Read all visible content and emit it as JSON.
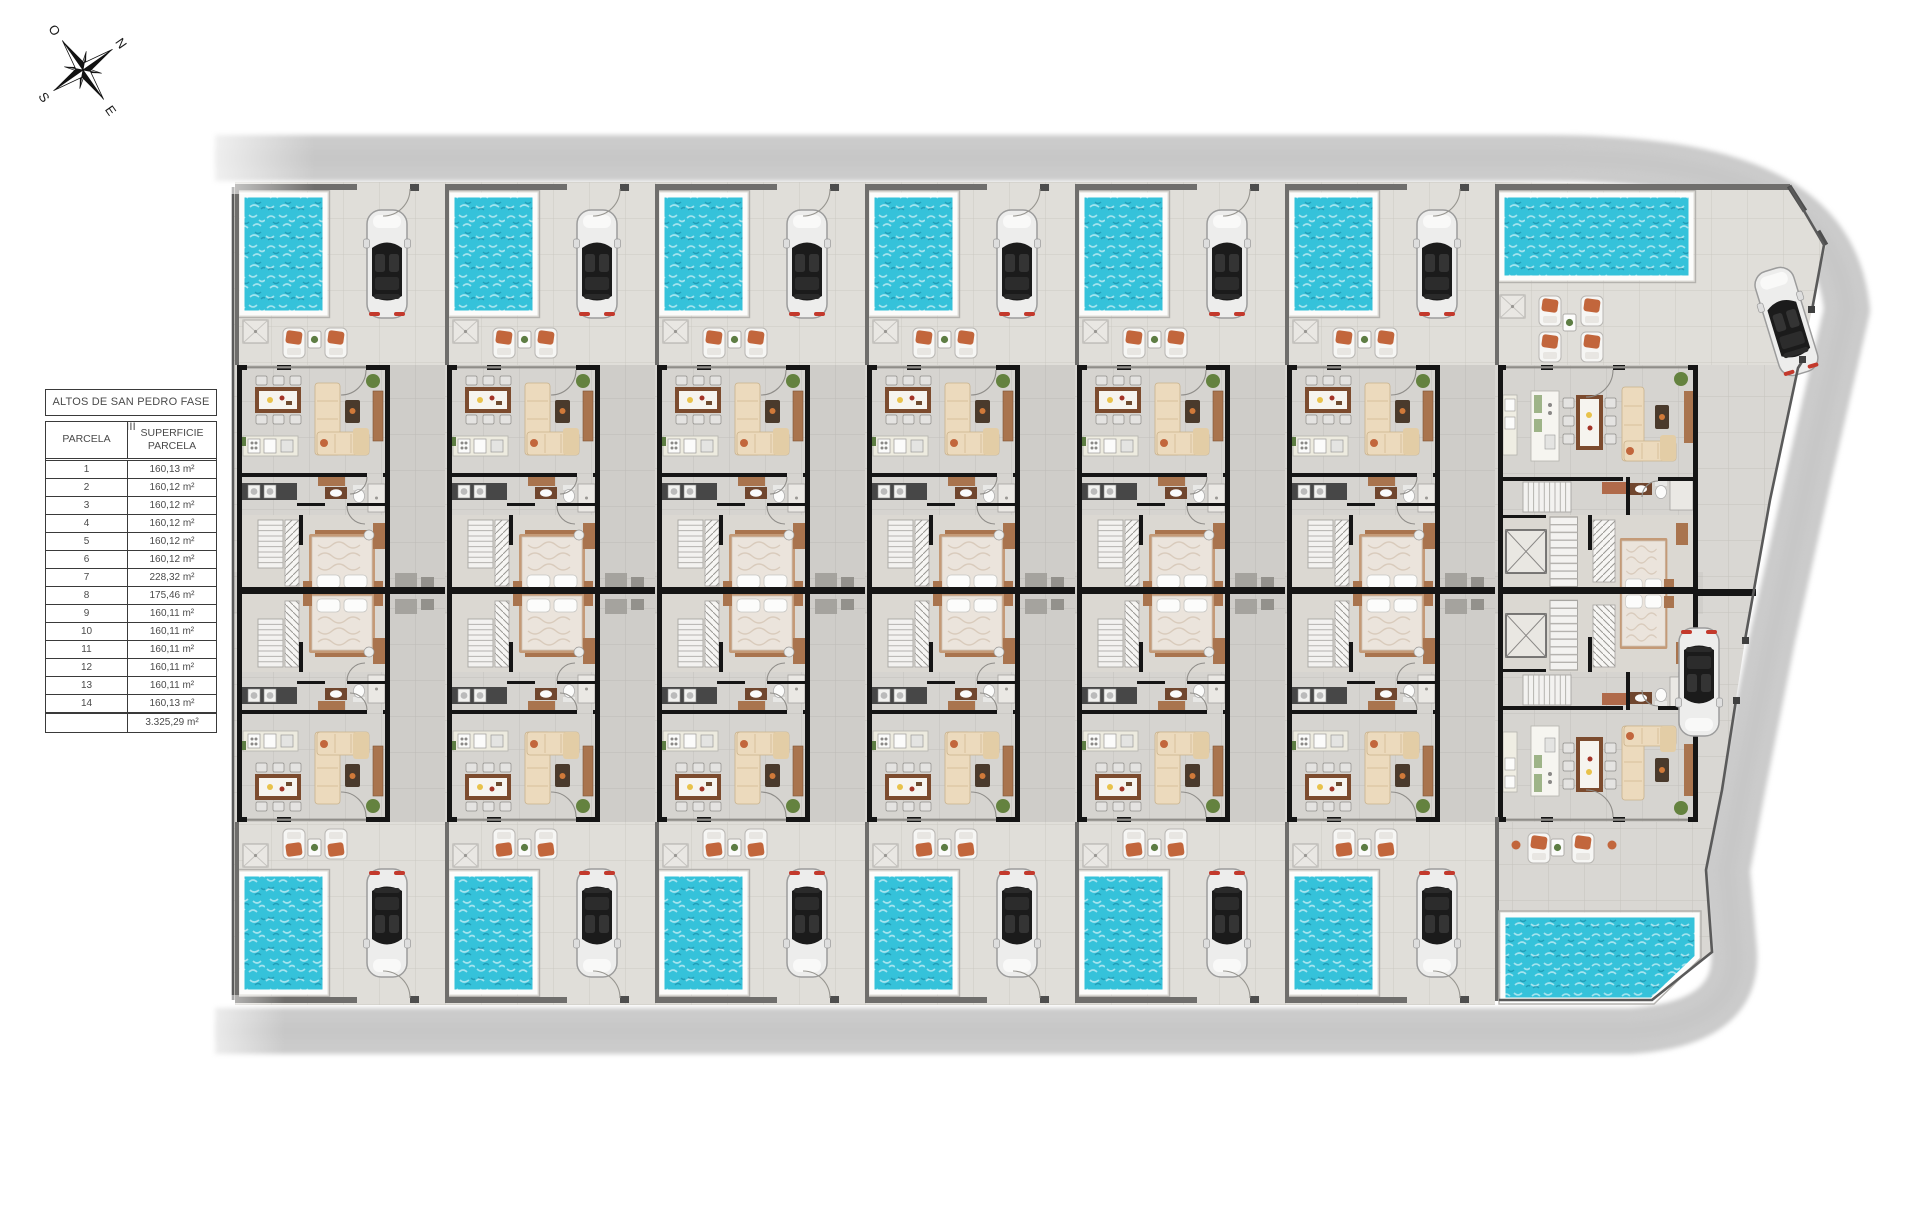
{
  "compass": {
    "north": "N",
    "south": "S",
    "east": "E",
    "west": "O"
  },
  "table": {
    "title": "ALTOS DE SAN PEDRO FASE III",
    "col_parcel": "PARCELA",
    "col_area": "SUPERFICIE PARCELA",
    "rows": [
      [
        "1",
        "160,13 m²"
      ],
      [
        "2",
        "160,12 m²"
      ],
      [
        "3",
        "160,12 m²"
      ],
      [
        "4",
        "160,12 m²"
      ],
      [
        "5",
        "160,12 m²"
      ],
      [
        "6",
        "160,12 m²"
      ],
      [
        "7",
        "228,32 m²"
      ],
      [
        "8",
        "175,46 m²"
      ],
      [
        "9",
        "160,11 m²"
      ],
      [
        "10",
        "160,11 m²"
      ],
      [
        "11",
        "160,11 m²"
      ],
      [
        "12",
        "160,11 m²"
      ],
      [
        "13",
        "160,11 m²"
      ],
      [
        "14",
        "160,13 m²"
      ]
    ],
    "total": "3.325,29 m²"
  },
  "colors": {
    "pool": "#35c2da",
    "poolDeep": "#0e86a6",
    "road": "#cbcbcb",
    "paving": "#d9d7d3",
    "terrace": "#e0ded9",
    "floor": "#d6d4d0",
    "passage": "#cfcdc9",
    "wall": "#151515",
    "fence": "#6f6e6c",
    "wood": "#7c4b2e",
    "woodLight": "#a9744e",
    "terracotta": "#c2663c",
    "cream": "#ecdabd",
    "bedFrame": "#c49a77",
    "green": "#5d7d43"
  }
}
